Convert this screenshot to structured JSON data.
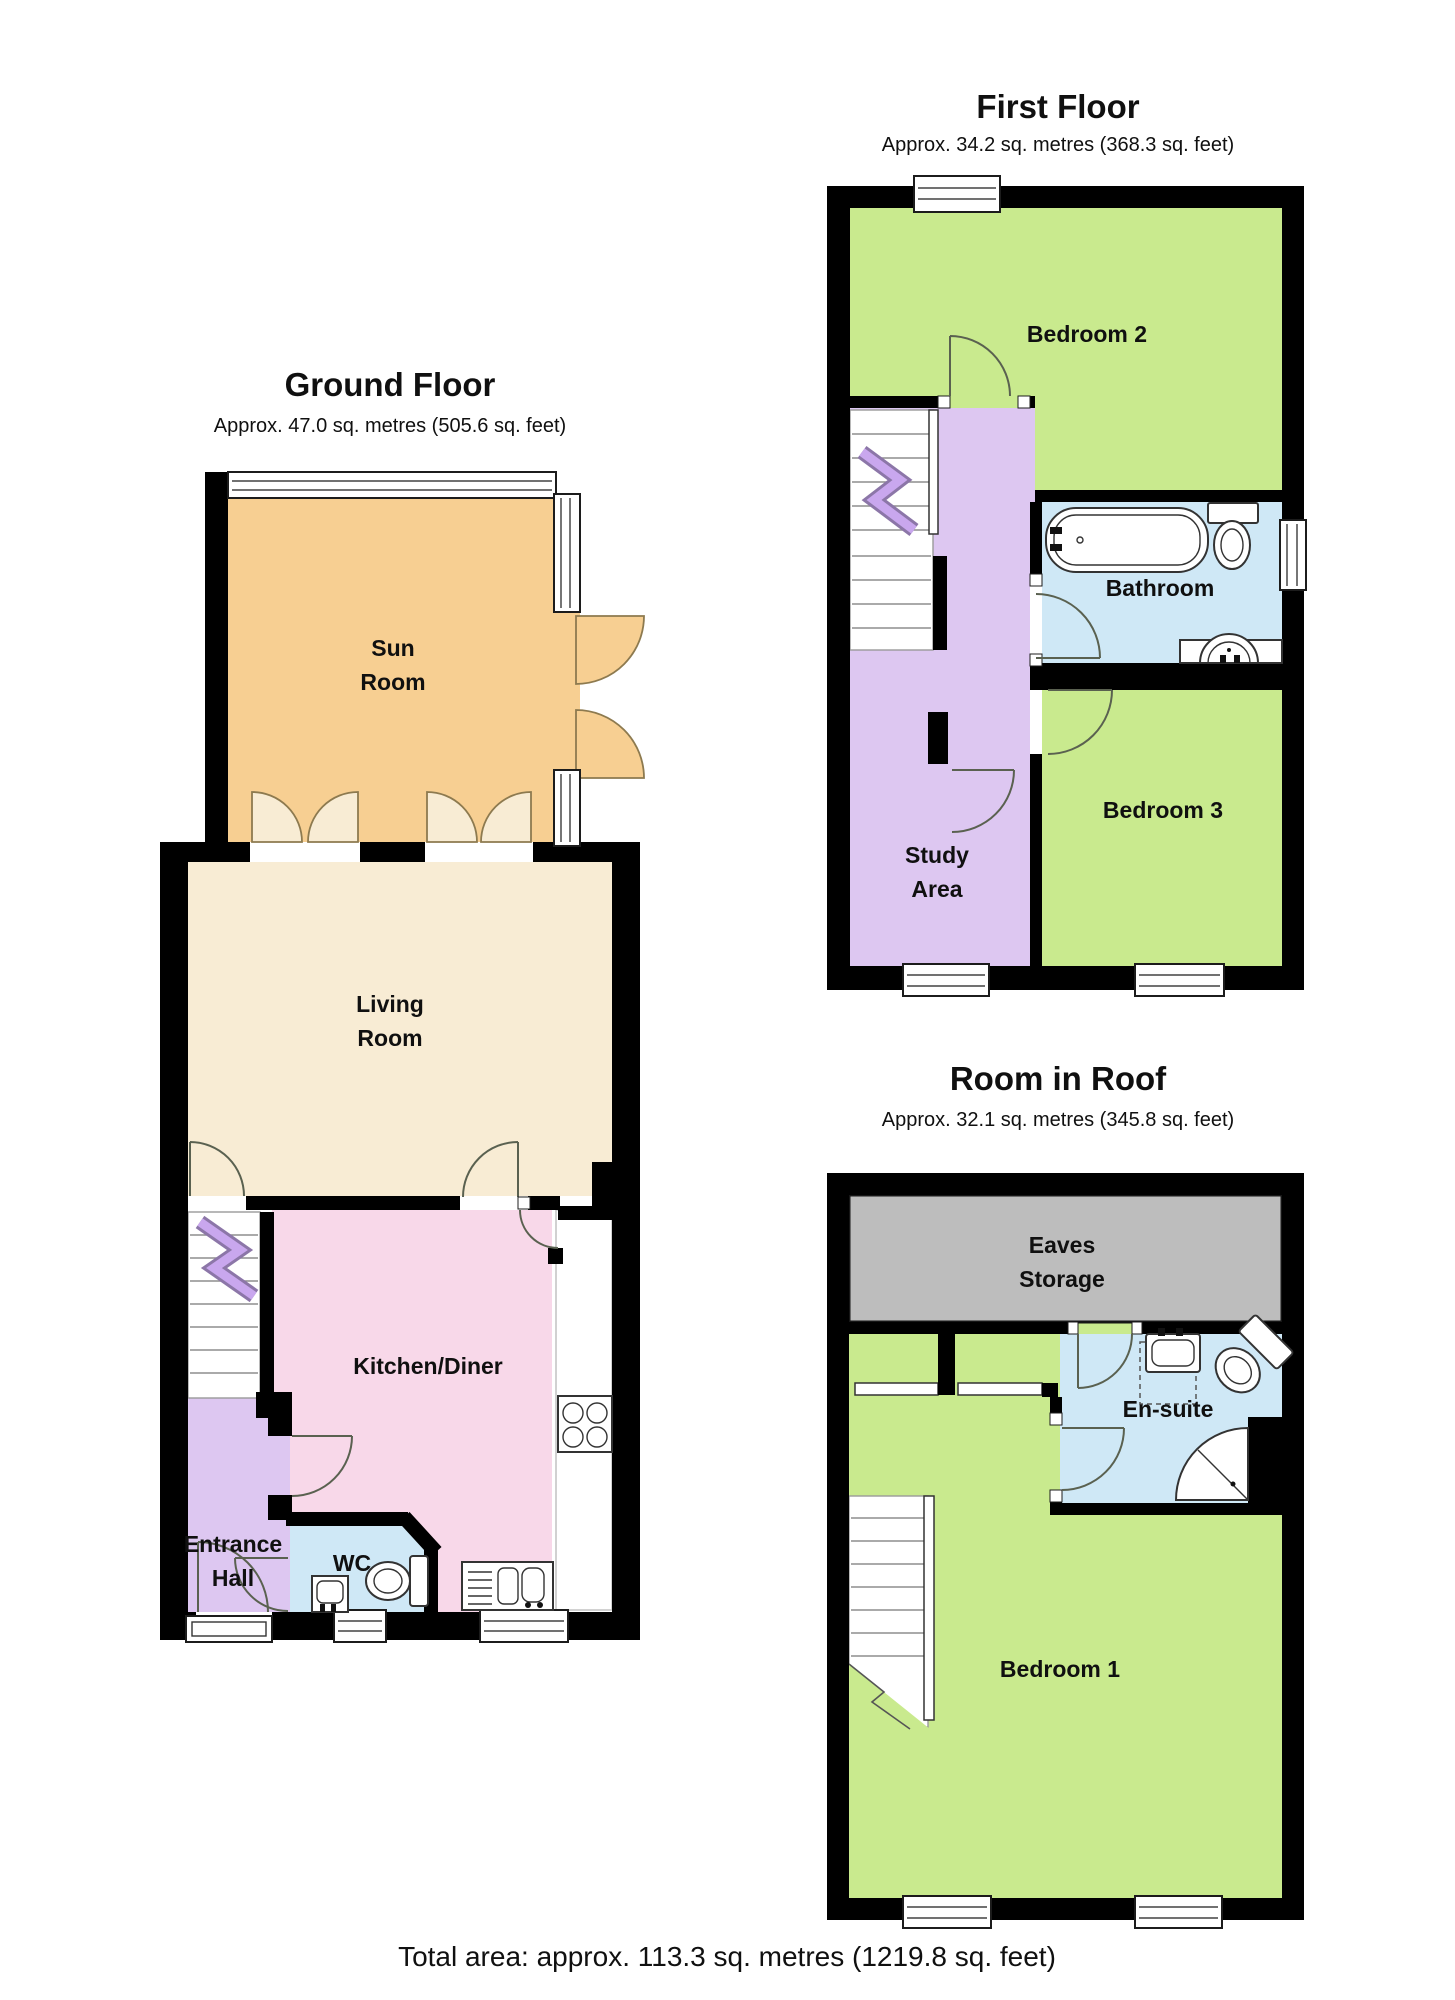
{
  "colors": {
    "wall": "#000000",
    "sun": "#f7cf92",
    "living": "#f8ecd4",
    "kitchen": "#f8d8e9",
    "hall": "#ddc7f1",
    "bath": "#cfe8f6",
    "bedroom": "#c9ea8e",
    "eaves": "#bdbdbd",
    "arrow": "#c9a7ee"
  },
  "floors": [
    {
      "title": "Ground Floor",
      "subtitle": "Approx. 47.0 sq. metres (505.6 sq. feet)",
      "rooms": [
        {
          "key": "sun-room",
          "lines": [
            "Sun",
            "Room"
          ]
        },
        {
          "key": "living-room",
          "lines": [
            "Living",
            "Room"
          ]
        },
        {
          "key": "kitchen-diner",
          "lines": [
            "Kitchen/Diner"
          ]
        },
        {
          "key": "entrance-hall",
          "lines": [
            "Entrance",
            "Hall"
          ]
        },
        {
          "key": "wc",
          "lines": [
            "WC"
          ]
        }
      ]
    },
    {
      "title": "First Floor",
      "subtitle": "Approx. 34.2 sq. metres (368.3 sq. feet)",
      "rooms": [
        {
          "key": "bedroom-2",
          "lines": [
            "Bedroom 2"
          ]
        },
        {
          "key": "bathroom",
          "lines": [
            "Bathroom"
          ]
        },
        {
          "key": "bedroom-3",
          "lines": [
            "Bedroom 3"
          ]
        },
        {
          "key": "study-area",
          "lines": [
            "Study",
            "Area"
          ]
        }
      ]
    },
    {
      "title": "Room in Roof",
      "subtitle": "Approx. 32.1 sq. metres (345.8 sq. feet)",
      "rooms": [
        {
          "key": "eaves-storage",
          "lines": [
            "Eaves",
            "Storage"
          ]
        },
        {
          "key": "en-suite",
          "lines": [
            "En-suite"
          ]
        },
        {
          "key": "bedroom-1",
          "lines": [
            "Bedroom 1"
          ]
        }
      ]
    }
  ],
  "footer": {
    "total": "Total area: approx. 113.3 sq. metres (1219.8 sq. feet)"
  }
}
